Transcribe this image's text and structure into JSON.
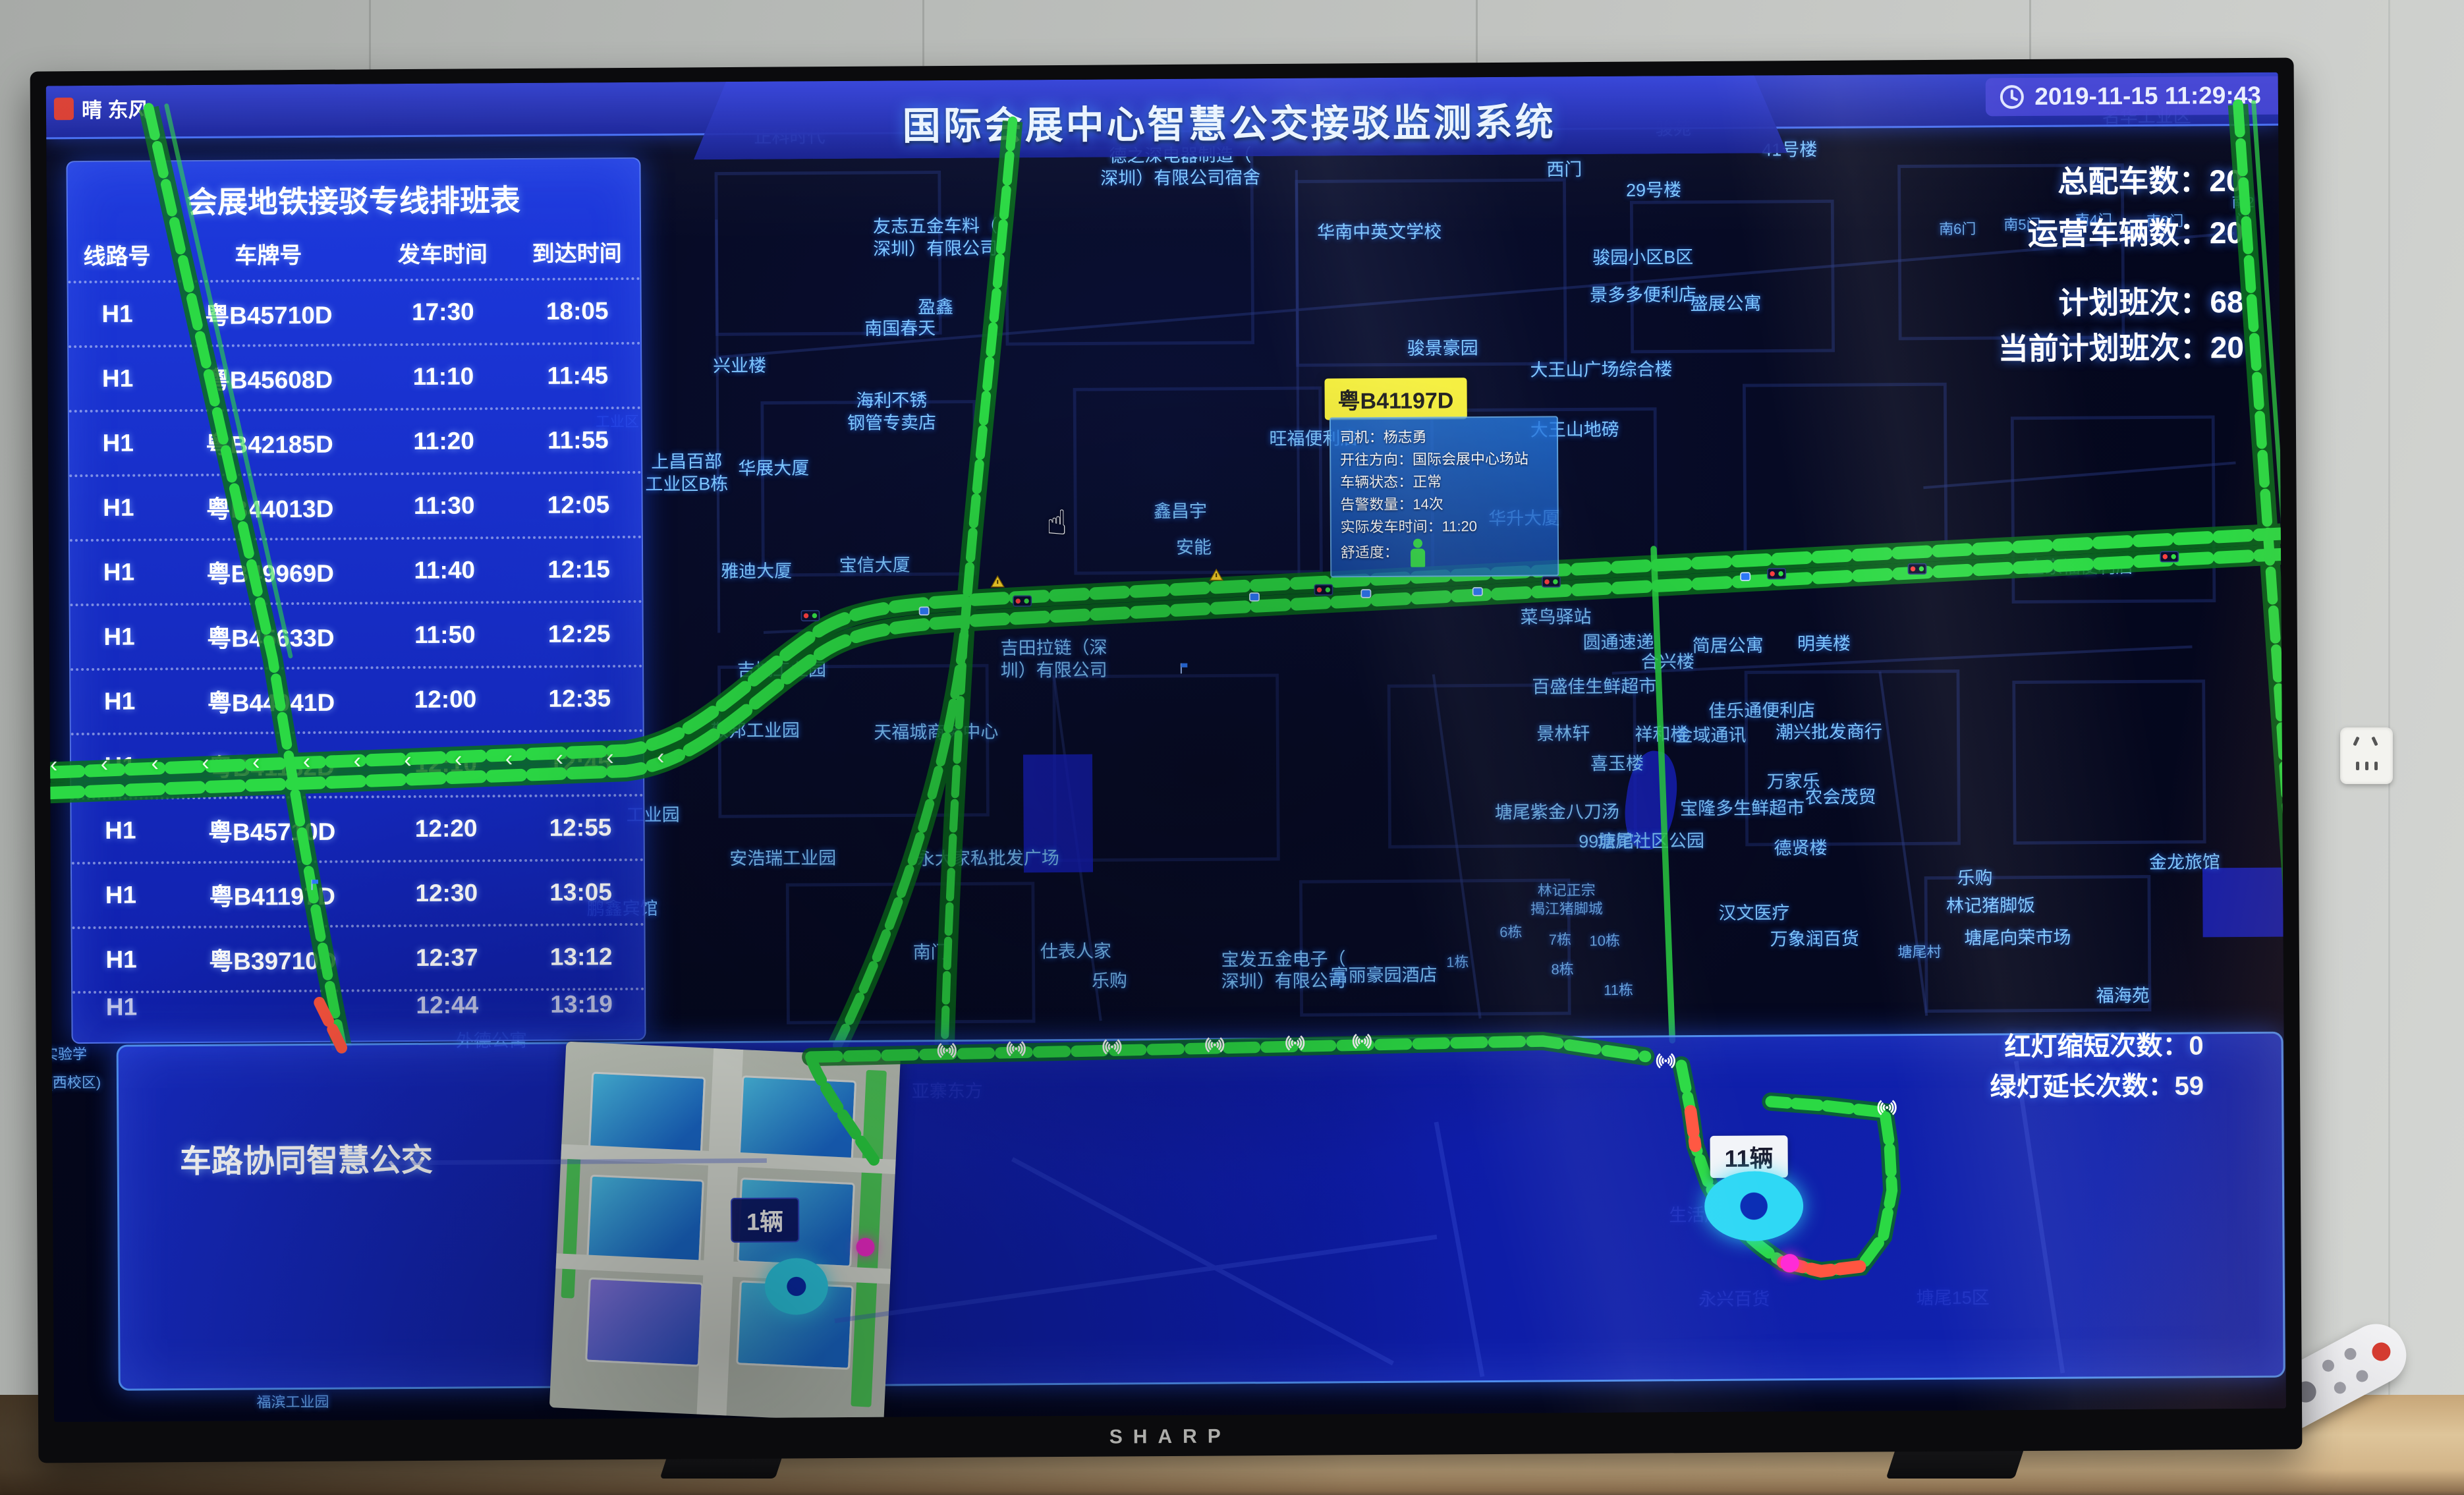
{
  "hardware": {
    "brand": "SHARP"
  },
  "header": {
    "weather": "晴 东风",
    "title": "国际会展中心智慧公交接驳监测系统",
    "timestamp": "2019-11-15 11:29:43"
  },
  "stats": {
    "items": [
      {
        "label": "总配车数",
        "value": "20"
      },
      {
        "label": "运营车辆数",
        "value": "20"
      },
      {
        "label": "计划班次",
        "value": "68"
      },
      {
        "label": "当前计划班次",
        "value": "20"
      }
    ]
  },
  "signal_stats": {
    "items": [
      {
        "label": "红灯缩短次数",
        "value": "0"
      },
      {
        "label": "绿灯延长次数",
        "value": "59"
      }
    ]
  },
  "schedule": {
    "title": "会展地铁接驳专线排班表",
    "columns": [
      "线路号",
      "车牌号",
      "发车时间",
      "到达时间"
    ],
    "rows": [
      [
        "H1",
        "粤B45710D",
        "17:30",
        "18:05"
      ],
      [
        "H1",
        "粤B45608D",
        "11:10",
        "11:45"
      ],
      [
        "H1",
        "粤B42185D",
        "11:20",
        "11:55"
      ],
      [
        "H1",
        "粤B44013D",
        "11:30",
        "12:05"
      ],
      [
        "H1",
        "粤B49969D",
        "11:40",
        "12:15"
      ],
      [
        "H1",
        "粤B45633D",
        "11:50",
        "12:25"
      ],
      [
        "H1",
        "粤B44041D",
        "12:00",
        "12:35"
      ],
      [
        "H1",
        "粤B41132D",
        "12:10",
        "12:45"
      ],
      [
        "H1",
        "粤B45710D",
        "12:20",
        "12:55"
      ],
      [
        "H1",
        "粤B41197D",
        "12:30",
        "13:05"
      ],
      [
        "H1",
        "粤B39710D",
        "12:37",
        "13:12"
      ],
      [
        "H1",
        "",
        "12:44",
        "13:19"
      ]
    ]
  },
  "popup": {
    "plate": "粤B41197D",
    "lines": [
      {
        "label": "司机",
        "value": "杨志勇"
      },
      {
        "label": "开往方向",
        "value": "国际会展中心场站"
      },
      {
        "label": "车辆状态",
        "value": "正常"
      },
      {
        "label": "告警数量",
        "value": "14次"
      },
      {
        "label": "实际发车时间",
        "value": "11:20"
      },
      {
        "label": "舒适度",
        "value": ""
      }
    ],
    "comfort_icon": "person-icon"
  },
  "bottom": {
    "title": "车路协同智慧公交",
    "count_labels": [
      {
        "text": "1辆",
        "x": 31.9,
        "y": 85.2,
        "style": "dark"
      },
      {
        "text": "11辆",
        "x": 76.0,
        "y": 80.9,
        "style": "light"
      }
    ],
    "donuts": [
      {
        "x": 33.3,
        "y": 90.2,
        "w": 96,
        "h": 86
      },
      {
        "x": 76.2,
        "y": 84.6,
        "w": 150,
        "h": 106
      }
    ],
    "magenta_dots": [
      {
        "x": 36.4,
        "y": 87.3
      },
      {
        "x": 77.8,
        "y": 88.9
      }
    ]
  },
  "map": {
    "labels": [
      [
        "正科时代",
        33.3,
        4.2
      ],
      [
        "德之深电器制造（\n深圳）有限公司宿舍",
        50.8,
        6.6
      ],
      [
        "友志五金车料（\n深圳）有限公司",
        39.8,
        11.8
      ],
      [
        "华南中英文学校",
        59.7,
        11.6
      ],
      [
        "盈鑫",
        39.8,
        17.0
      ],
      [
        "南国春天",
        38.2,
        18.6
      ],
      [
        "兴业楼",
        31.0,
        21.3
      ],
      [
        "海利不锈\n钢管专卖店",
        37.8,
        24.8
      ],
      [
        "骏苑",
        72.9,
        4.0
      ],
      [
        "41号楼",
        78.1,
        5.6
      ],
      [
        "西门",
        68.0,
        7.0
      ],
      [
        "29号楼",
        72.0,
        8.6
      ],
      [
        "名华工业区",
        94.1,
        3.3
      ],
      [
        "南6门",
        85.6,
        11.6,
        "sm"
      ],
      [
        "南5门",
        88.5,
        11.3,
        "sm"
      ],
      [
        "南4门",
        91.7,
        11.0,
        "sm"
      ],
      [
        "南3门",
        94.9,
        11.1,
        "sm"
      ],
      [
        "南2门",
        98.4,
        10.4,
        "sm"
      ],
      [
        "骏园小区B区",
        71.5,
        13.6
      ],
      [
        "景多多便利店",
        71.5,
        16.4
      ],
      [
        "盛展公寓",
        75.2,
        17.1
      ],
      [
        "骏景豪园",
        62.5,
        20.3
      ],
      [
        "大王山广场综合楼",
        69.6,
        22.0
      ],
      [
        "大王山地磅",
        68.4,
        26.5
      ],
      [
        "旺福便利店",
        56.7,
        27.0
      ],
      [
        "工业区",
        25.5,
        25.4,
        "sm"
      ],
      [
        "上昌百部\n工业区B栋",
        28.6,
        29.3
      ],
      [
        "华展大厦",
        32.5,
        29.0
      ],
      [
        "鑫昌宇",
        50.7,
        32.4
      ],
      [
        "安能",
        51.3,
        35.1
      ],
      [
        "宝信大厦",
        37.0,
        36.3
      ],
      [
        "雅迪大厦",
        31.7,
        36.7
      ],
      [
        "华升大厦",
        66.1,
        33.1
      ],
      [
        "金家福便利店",
        91.0,
        37.0
      ],
      [
        "菜鸟驿站",
        67.5,
        40.5
      ],
      [
        "圆通速递",
        70.3,
        42.4
      ],
      [
        "合兴楼",
        72.5,
        43.9
      ],
      [
        "简居公寓",
        75.2,
        42.7
      ],
      [
        "明美楼",
        79.5,
        42.6
      ],
      [
        "百盛佳生鲜超市",
        69.2,
        45.7
      ],
      [
        "佳乐通便利店",
        76.7,
        47.6
      ],
      [
        "潮兴批发商行",
        79.7,
        49.2
      ],
      [
        "景林轩",
        67.8,
        49.2
      ],
      [
        "祥和楼",
        72.2,
        49.3
      ],
      [
        "金域通讯",
        74.4,
        49.4
      ],
      [
        "喜玉楼",
        70.2,
        51.5
      ],
      [
        "万家乐",
        78.1,
        52.9
      ],
      [
        "农会茂贸",
        80.2,
        54.1
      ],
      [
        "塘尾紫金八刀汤",
        67.5,
        55.1
      ],
      [
        "宝隆多生鲜超市",
        75.8,
        54.9
      ],
      [
        "99旅馆",
        69.7,
        57.3
      ],
      [
        "塘尾社区公园",
        71.7,
        57.3
      ],
      [
        "德贤楼",
        78.4,
        57.9
      ],
      [
        "金龙旅馆",
        95.6,
        59.1
      ],
      [
        "林记正宗\n揭江猪脚城",
        67.9,
        61.6,
        "sm"
      ],
      [
        "汉文医疗",
        76.3,
        62.7
      ],
      [
        "万象润百货",
        79.0,
        64.7
      ],
      [
        "乐购",
        86.2,
        60.2
      ],
      [
        "林记猪脚饭",
        86.9,
        62.3
      ],
      [
        "塘尾向荣市场",
        88.1,
        64.7
      ],
      [
        "塘尾村",
        83.7,
        65.7,
        "sm"
      ],
      [
        "福海苑",
        92.8,
        69.1
      ],
      [
        "吉田拉链（深\n圳）有限公司",
        45.0,
        43.4
      ],
      [
        "吉城工业园",
        32.8,
        44.1
      ],
      [
        "敬邦工业园",
        31.6,
        48.6
      ],
      [
        "天福城商务中心",
        39.7,
        48.8
      ],
      [
        "工业园",
        27.0,
        54.9
      ],
      [
        "安浩瑞工业园",
        32.8,
        58.2
      ],
      [
        "永大家私批发广场",
        42.0,
        58.3
      ],
      [
        "鹏鑫宾馆",
        25.6,
        61.9
      ],
      [
        "南门",
        39.4,
        65.3
      ],
      [
        "仕表人家",
        45.9,
        65.3
      ],
      [
        "乐购",
        47.4,
        67.5
      ],
      [
        "宝发五金电子（\n深圳）有限公司",
        55.2,
        66.8
      ],
      [
        "富丽豪园酒店",
        59.7,
        67.2
      ],
      [
        "外德公寓",
        19.7,
        71.7
      ],
      [
        "1栋",
        63.0,
        66.2,
        "sm"
      ],
      [
        "6栋",
        65.4,
        64.0,
        "sm"
      ],
      [
        "7栋",
        67.6,
        64.6,
        "sm"
      ],
      [
        "10栋",
        69.6,
        64.7,
        "sm"
      ],
      [
        "8栋",
        67.7,
        66.8,
        "sm"
      ],
      [
        "11栋",
        70.2,
        68.4,
        "sm"
      ],
      [
        "实验学",
        0.6,
        72.5,
        "sm"
      ],
      [
        "(西校区)",
        1.0,
        74.6,
        "sm"
      ],
      [
        "福滨工业园",
        10.7,
        98.6,
        "sm"
      ],
      [
        "亚寨东方",
        40.1,
        75.7,
        "faint"
      ],
      [
        "永兴百货",
        75.3,
        91.6,
        "faint"
      ],
      [
        "生活超市",
        74.0,
        85.3,
        "faint"
      ],
      [
        "塘尾15区",
        85.1,
        91.6,
        "faint"
      ]
    ],
    "icons": {
      "wifi": [
        [
          40.1,
          72.6
        ],
        [
          43.2,
          72.5
        ],
        [
          47.5,
          72.4
        ],
        [
          52.1,
          72.3
        ],
        [
          55.7,
          72.2
        ],
        [
          58.7,
          72.1
        ],
        [
          72.3,
          73.7
        ],
        [
          82.2,
          77.3
        ]
      ],
      "traffic_lights": [
        [
          34.1,
          40.0
        ],
        [
          43.6,
          39.0
        ],
        [
          57.1,
          38.3
        ],
        [
          67.3,
          37.8
        ],
        [
          77.4,
          37.3
        ],
        [
          83.7,
          37.0
        ],
        [
          95.0,
          36.2
        ]
      ],
      "buses": [
        [
          39.2,
          39.7
        ],
        [
          54.0,
          38.8
        ],
        [
          59.0,
          38.6
        ],
        [
          64.0,
          38.5
        ],
        [
          76.0,
          37.5
        ]
      ],
      "warnings": [
        [
          42.5,
          37.6
        ],
        [
          52.3,
          37.2
        ]
      ],
      "flags": [
        [
          50.7,
          44.5
        ],
        [
          11.7,
          60.3
        ]
      ]
    }
  },
  "colors": {
    "road_green": "#2bd944",
    "alert_red": "#ff5540",
    "panel_blue": "#1c3ae0",
    "tag_yellow": "#f5ef3c",
    "marker_magenta": "#ff2bd6",
    "marker_cyan": "#2fd8f5"
  }
}
